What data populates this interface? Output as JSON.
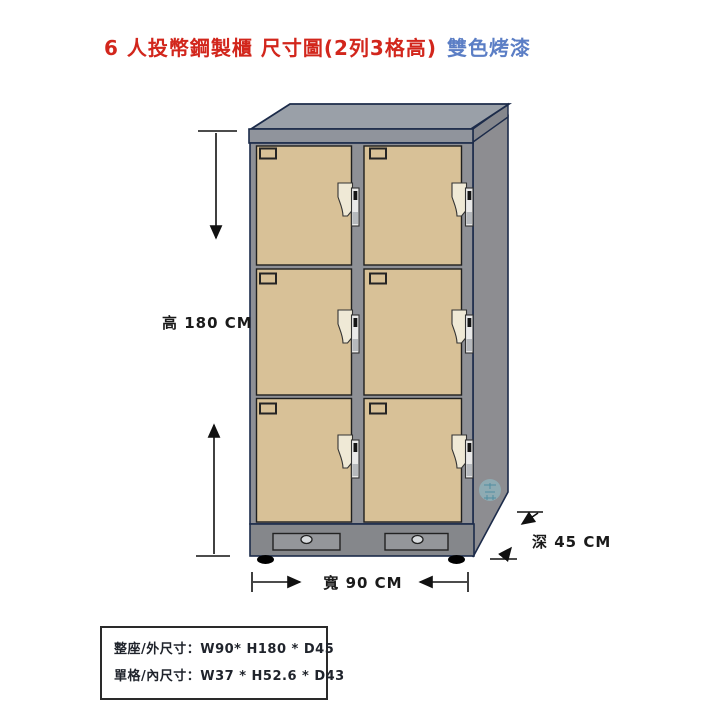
{
  "title": {
    "main": "6 人投幣鋼製櫃 尺寸圖(2列3格高)",
    "accent": "雙色烤漆"
  },
  "dimensions": {
    "height_label": "高 180 CM",
    "width_label": "寬 90 CM",
    "depth_label": "深 45 CM"
  },
  "spec_table": {
    "rows": [
      "整座/外尺寸：W90* H180 * D45",
      "單格/內尺寸：W37 * H52.6 * D43"
    ]
  },
  "locker": {
    "columns": 2,
    "rows": 3,
    "door_count": 6
  },
  "colors": {
    "title_red": "#d2261c",
    "title_blue": "#5b7ec5",
    "door_tan": "#d8c197",
    "cabinet_gray": "#8e9096",
    "cabinet_top_gray": "#9aa0a8",
    "outline_navy": "#1c2b4a",
    "watermark_cyan": "#8fd6e4"
  }
}
